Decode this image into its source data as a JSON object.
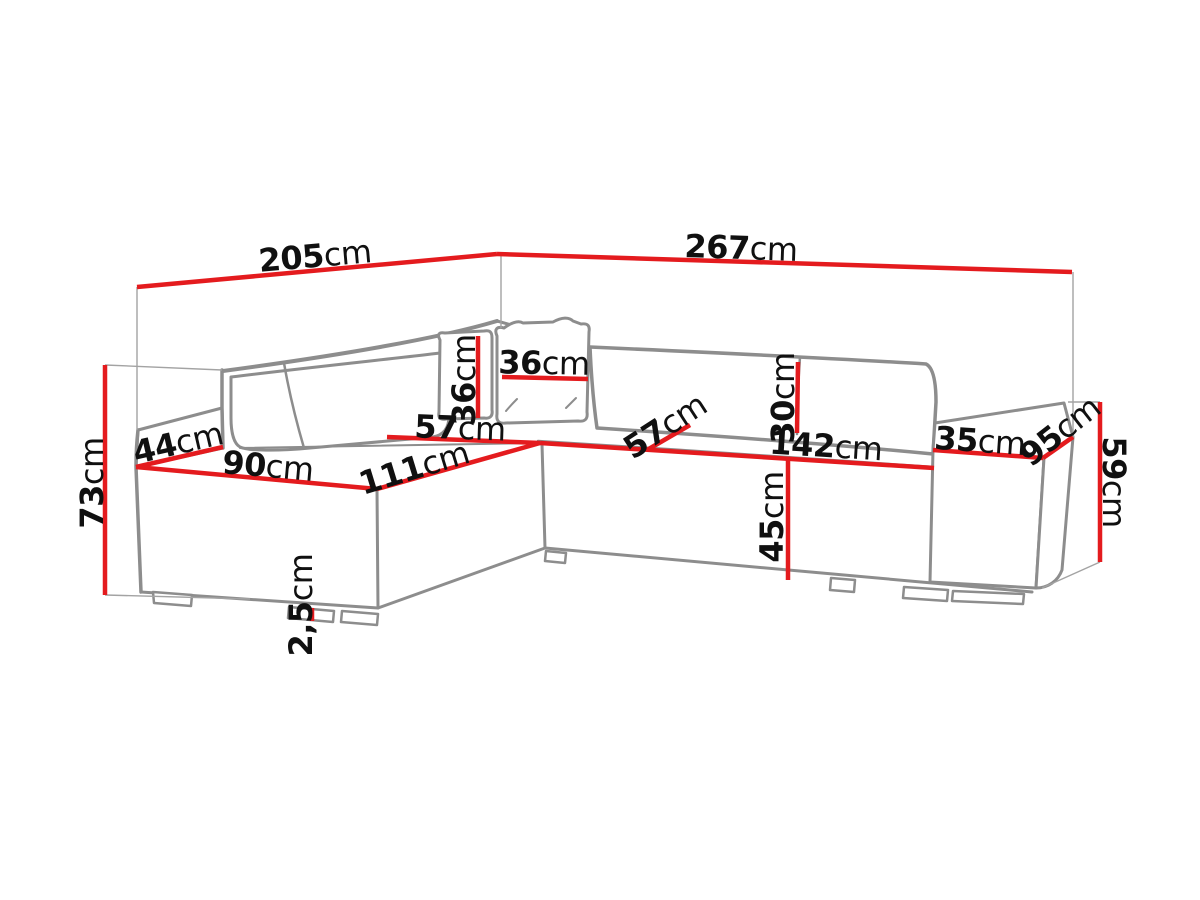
{
  "diagram": {
    "type": "furniture-dimension-drawing",
    "subject": "corner-sofa",
    "unit": "cm",
    "colors": {
      "dimension_line": "#e41b1e",
      "sofa_outline": "#8d8d8d",
      "label_text": "#101010",
      "background": "#ffffff"
    }
  },
  "dims": {
    "d205": {
      "value": "205",
      "unit": "cm"
    },
    "d267": {
      "value": "267",
      "unit": "cm"
    },
    "d73": {
      "value": "73",
      "unit": "cm"
    },
    "d44": {
      "value": "44",
      "unit": "cm"
    },
    "d90": {
      "value": "90",
      "unit": "cm"
    },
    "d111": {
      "value": "111",
      "unit": "cm"
    },
    "d57corner": {
      "value": "57",
      "unit": "cm"
    },
    "d36left": {
      "value": "36",
      "unit": "cm"
    },
    "d36front": {
      "value": "36",
      "unit": "cm"
    },
    "d57seat": {
      "value": "57",
      "unit": "cm"
    },
    "d30": {
      "value": "30",
      "unit": "cm"
    },
    "d142": {
      "value": "142",
      "unit": "cm"
    },
    "d35": {
      "value": "35",
      "unit": "cm"
    },
    "d95": {
      "value": "95",
      "unit": "cm"
    },
    "d59": {
      "value": "59",
      "unit": "cm"
    },
    "d45": {
      "value": "45",
      "unit": "cm"
    },
    "d25": {
      "value": "2,5",
      "unit": "cm"
    }
  }
}
